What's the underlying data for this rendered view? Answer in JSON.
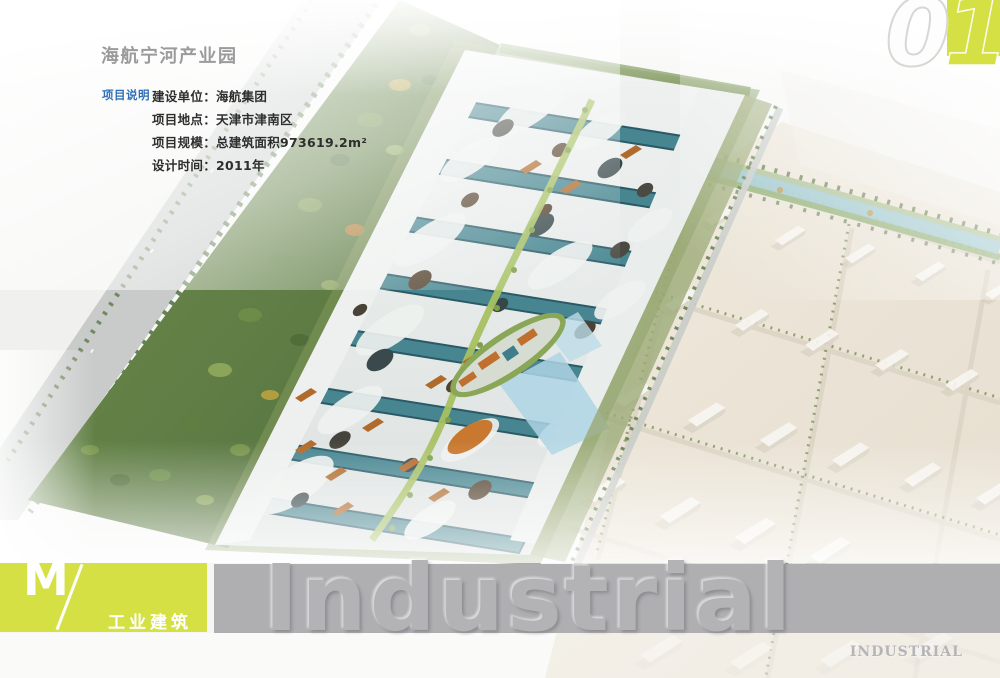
{
  "header": {
    "title": "海航宁河产业园"
  },
  "page_number": {
    "value": "01",
    "digits": [
      "0",
      "1"
    ]
  },
  "project_info": {
    "label": "项目说明",
    "lines": [
      "建设单位：海航集团",
      "项目地点：天津市津南区",
      "项目规模：总建筑面积973619.2m²",
      "设计时间：2011年"
    ]
  },
  "footer_banner": {
    "logo_letter": "M",
    "slash_icon": "diagonal-slash",
    "category": "工业建筑",
    "watermark": "Industrial",
    "corner_label": "INDUSTRIAL"
  },
  "illustration": {
    "name": "aerial-rendering-industrial-park"
  },
  "colors": {
    "accent_yellow_green": "#d5e045",
    "banner_gray": "#afaeb1",
    "label_blue": "#2f6eb5",
    "title_gray": "#9b9b9b",
    "text_dark": "#2e2e2e"
  }
}
